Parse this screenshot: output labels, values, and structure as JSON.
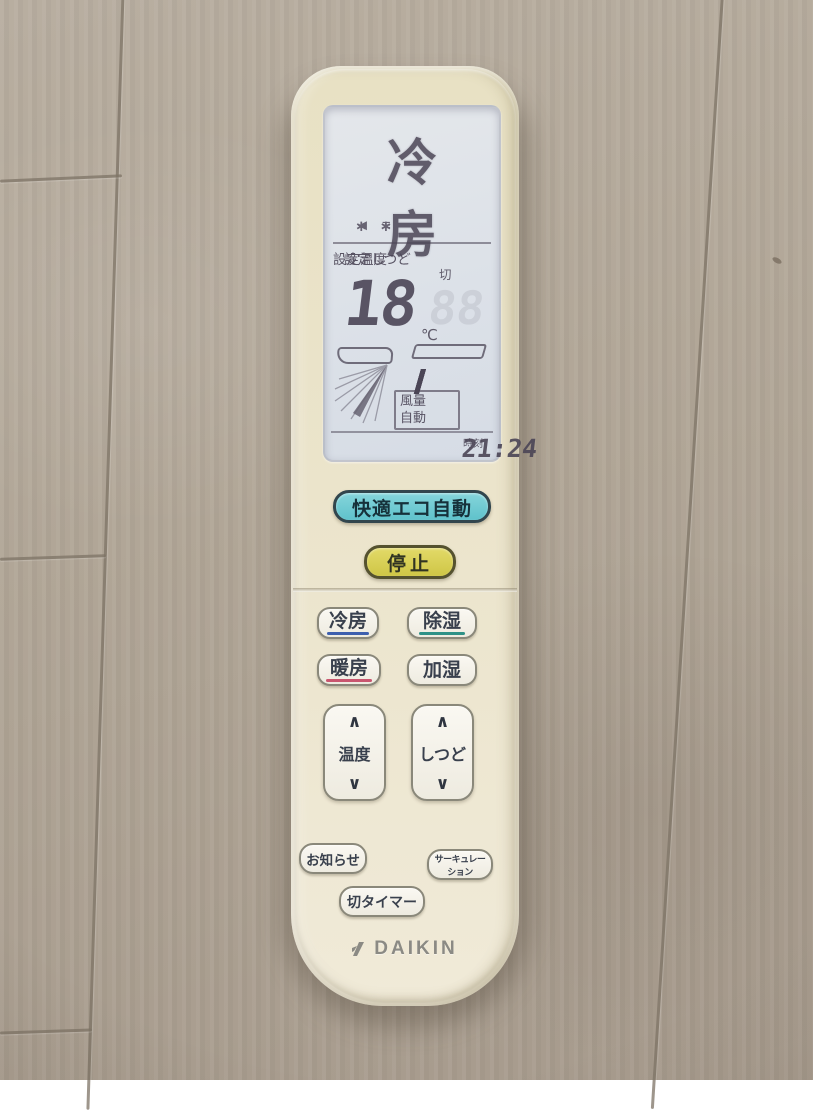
{
  "colors": {
    "seam": "#7e7466",
    "ink": "#4b4556",
    "eco-border": "#32464d",
    "eco-text": "#16313a",
    "stop-border": "#55522f",
    "stop-text": "#313422",
    "btn-border": "#8a887a",
    "btn-text": "#39404d",
    "underline-cool": "#3d5fae",
    "underline-dry": "#2e9187",
    "underline-heat": "#c9566f",
    "logo": "#8b8a84"
  },
  "remote": {
    "brand": "DAIKIN",
    "lcd": {
      "mode": "冷房",
      "icon_left": "◄≡",
      "icon_right": "∗∗",
      "set_temp_label": "設定温度",
      "set_humidity_label": "設定しつど",
      "humidity_off": "切",
      "temperature": "18",
      "temp_unit": "℃",
      "humidity_ghost": "88",
      "fan_label_1": "風量",
      "fan_label_2": "自動",
      "fan_bars": [
        0,
        0,
        0,
        1,
        1,
        1,
        0,
        0,
        0
      ],
      "time": "21:24",
      "time_label": "時刻"
    },
    "buttons": {
      "eco": "快適エコ自動",
      "stop": "停止",
      "cool": "冷房",
      "dry": "除湿",
      "heat": "暖房",
      "humidify": "加湿",
      "temp_rocker": "温度",
      "humidity_rocker": "しつど",
      "up": "∧",
      "down": "∨",
      "notice": "お知らせ",
      "circulation": "サーキュレーション",
      "off_timer": "切タイマー"
    }
  }
}
